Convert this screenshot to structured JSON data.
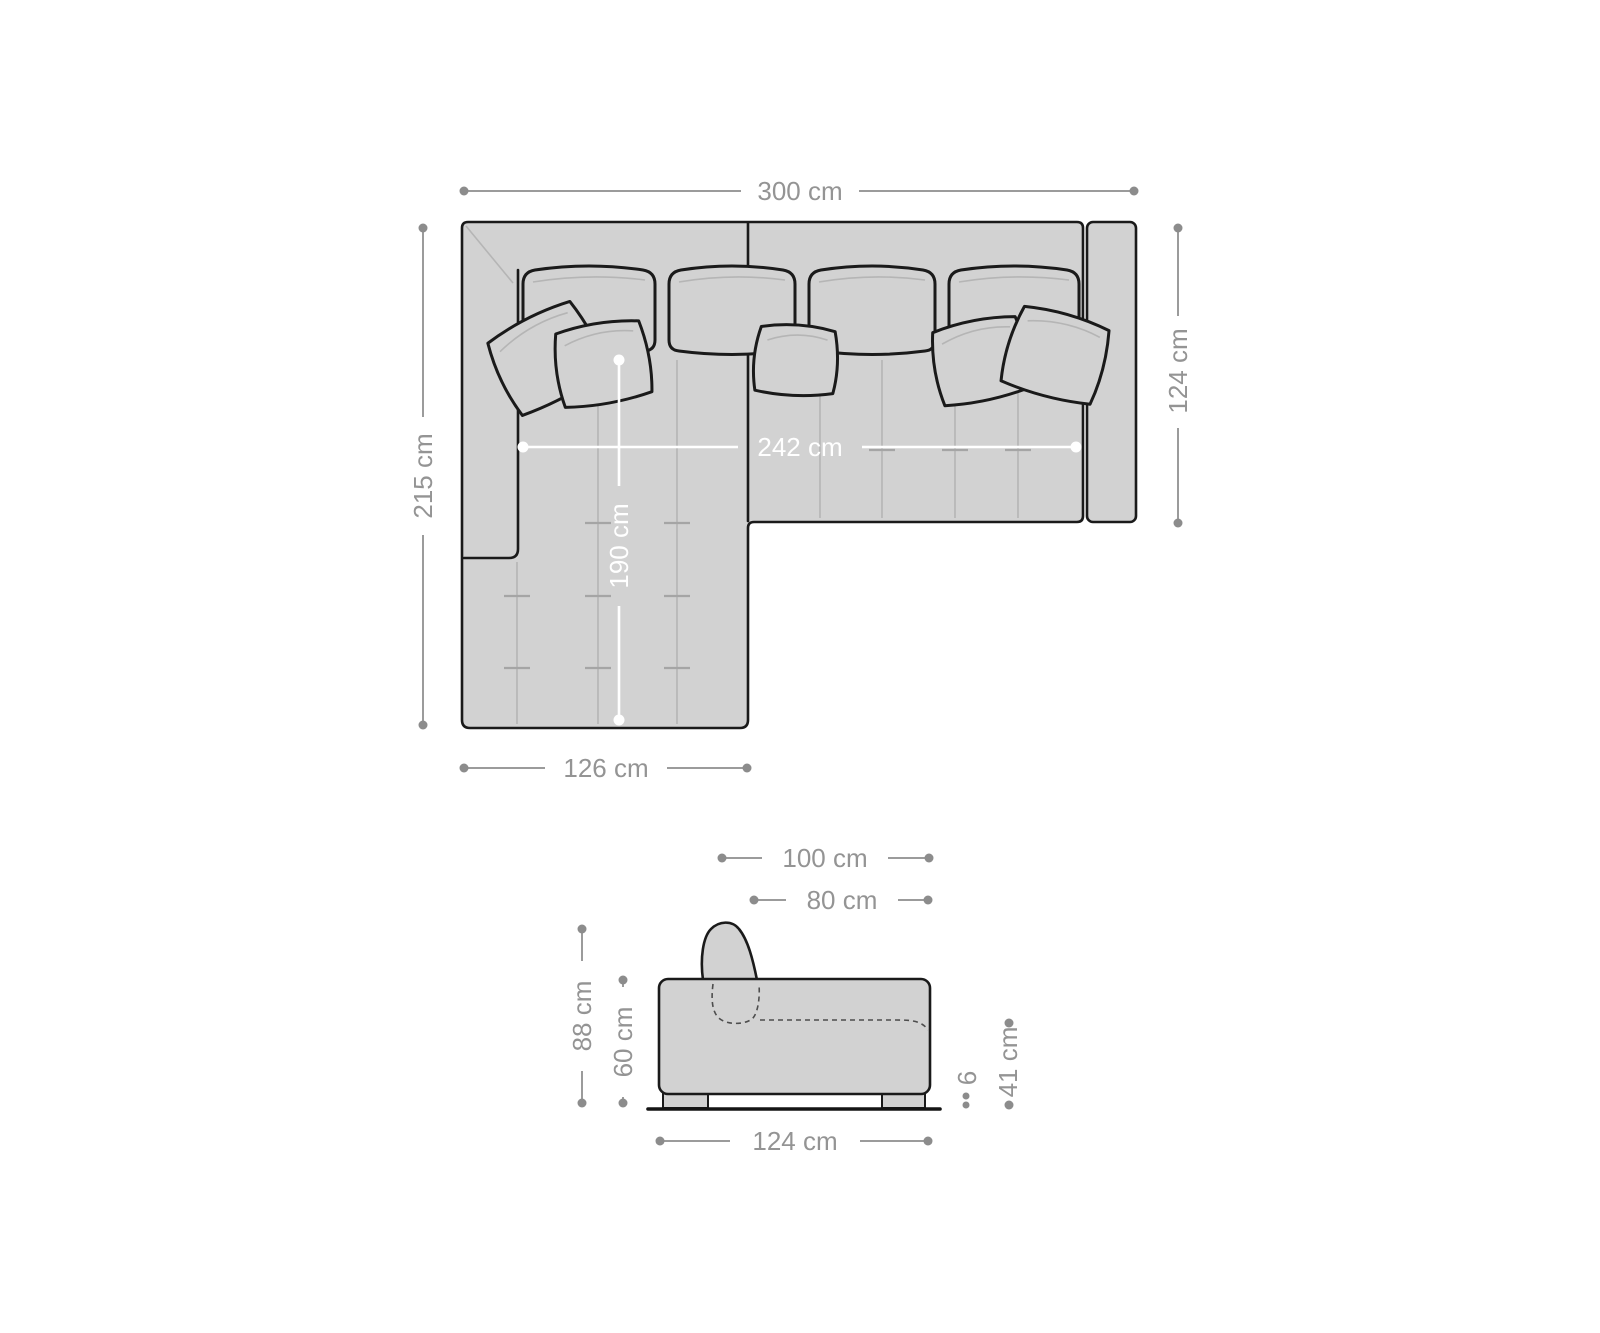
{
  "colors": {
    "background": "#ffffff",
    "sofa_fill": "#d2d2d2",
    "outline": "#1a1a1a",
    "seam": "#b5b5b5",
    "dimension_line": "#9b9b9b",
    "dimension_text": "#949494",
    "dimension_white": "#ffffff"
  },
  "top_view": {
    "total_width": "300 cm",
    "total_depth": "215 cm",
    "sofa_depth": "124 cm",
    "recamiere_width": "126 cm",
    "inner_seat_width": "242 cm",
    "recamiere_seat_depth": "190 cm"
  },
  "side_view": {
    "total_depth": "100 cm",
    "seat_depth": "80 cm",
    "total_height": "88 cm",
    "body_height": "60 cm",
    "base_depth": "124 cm",
    "seat_height": "41 cm",
    "foot_height": "6"
  }
}
